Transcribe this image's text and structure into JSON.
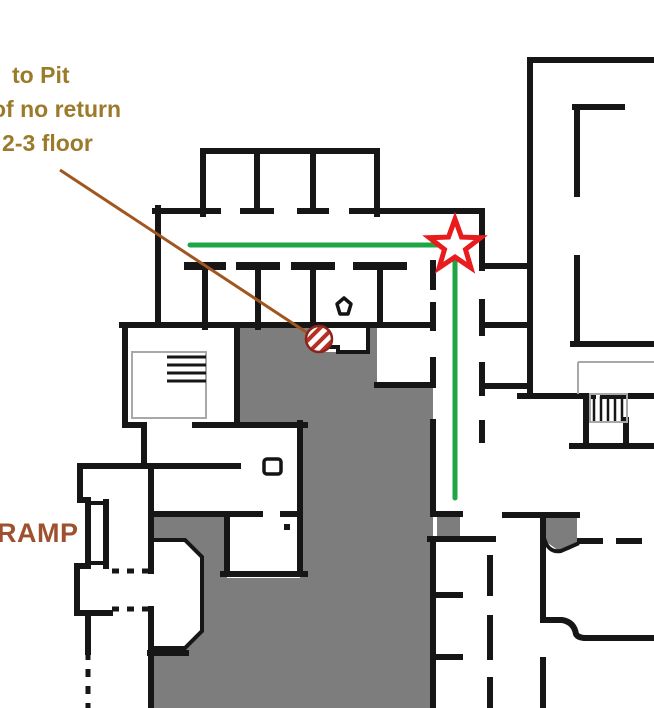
{
  "map": {
    "labels": {
      "pit_line1": "to Pit",
      "pit_line2": "of no return",
      "pit_line3": ": 2-3 floor",
      "ramp": "RAMP"
    },
    "markers": {
      "destination": "star-icon",
      "hazard": "hatched-circle-icon",
      "item": "pentagon-icon"
    }
  },
  "colors": {
    "wall": "#161616",
    "shadow": "#7d7d7d",
    "route": "#1ea546",
    "star": "#e81c1c",
    "pointer": "#a0561e",
    "hatch": "#b53125",
    "pit_text": "#9b7b2b",
    "ramp_text": "#9e512e",
    "thin": "#a8a8a8"
  }
}
